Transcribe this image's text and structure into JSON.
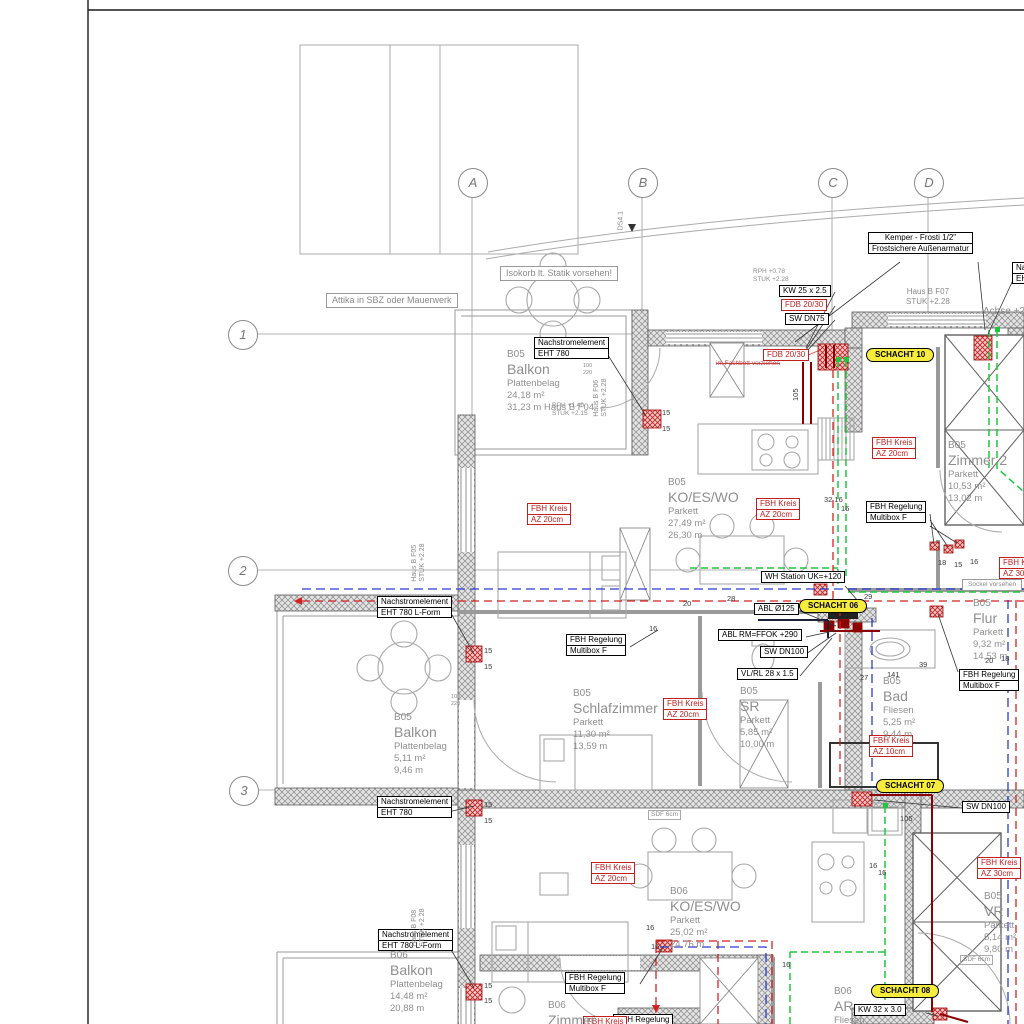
{
  "title": "Grundriss Haus B - Heizung/Sanitaer Installationsplan",
  "colors": {
    "pipe_green": "#1ec73c",
    "pipe_red_dashed": "#d42222",
    "pipe_blue_dashed": "#2b3bd4",
    "pipe_dark_red": "#8b0000",
    "label_red": "#c21f1f",
    "schacht_yellow": "#f6ec3d",
    "wall_hatch_gray": "#e3e3e3",
    "room_text_gray": "#8f8f8f"
  },
  "axes": {
    "letters": [
      {
        "label": "A",
        "x": 472,
        "y": 182
      },
      {
        "label": "B",
        "x": 642,
        "y": 182
      },
      {
        "label": "C",
        "x": 832,
        "y": 182
      },
      {
        "label": "D",
        "x": 928,
        "y": 182
      }
    ],
    "numbers": [
      {
        "label": "1",
        "x": 242,
        "y": 334
      },
      {
        "label": "2",
        "x": 242,
        "y": 570
      },
      {
        "label": "3",
        "x": 243,
        "y": 790
      }
    ]
  },
  "annotations": {
    "notes": [
      {
        "x": 534,
        "y": 337,
        "lines": [
          "Nachstromelement",
          "EHT 780"
        ]
      },
      {
        "x": 868,
        "y": 232,
        "center": true,
        "lines": [
          "Kemper - Frosti 1/2\"",
          "Frostsichere Außenarmatur"
        ]
      },
      {
        "x": 779,
        "y": 285,
        "lines": [
          "KW 25 x 2.5"
        ]
      },
      {
        "x": 781,
        "y": 299,
        "red": true,
        "lines": [
          "FDB 20/30"
        ]
      },
      {
        "x": 785,
        "y": 313,
        "lines": [
          "SW DN75"
        ]
      },
      {
        "x": 377,
        "y": 596,
        "lines": [
          "Nachstromelement",
          "EHT 780 L-Form"
        ]
      },
      {
        "x": 866,
        "y": 501,
        "lines": [
          "FBH Regelung",
          "Multibox F"
        ]
      },
      {
        "x": 566,
        "y": 634,
        "lines": [
          "FBH Regelung",
          "Multibox F"
        ]
      },
      {
        "x": 761,
        "y": 571,
        "lines": [
          "WH Station UK=+120"
        ]
      },
      {
        "x": 754,
        "y": 603,
        "lines": [
          "ABL Ø125"
        ]
      },
      {
        "x": 718,
        "y": 629,
        "lines": [
          "ABL RM=FFOK +290"
        ]
      },
      {
        "x": 760,
        "y": 646,
        "lines": [
          "SW DN100"
        ]
      },
      {
        "x": 737,
        "y": 668,
        "lines": [
          "VL/RL 28 x 1.5"
        ]
      },
      {
        "x": 959,
        "y": 669,
        "lines": [
          "FBH Regelung",
          "Multibox F"
        ]
      },
      {
        "x": 377,
        "y": 796,
        "lines": [
          "Nachstromelement",
          "EHT 780"
        ]
      },
      {
        "x": 962,
        "y": 801,
        "lines": [
          "SW DN100"
        ]
      },
      {
        "x": 378,
        "y": 929,
        "lines": [
          "Nachstromelement",
          "EHT 780 L-Form"
        ]
      },
      {
        "x": 565,
        "y": 972,
        "lines": [
          "FBH Regelung",
          "Multibox F"
        ]
      },
      {
        "x": 854,
        "y": 1004,
        "lines": [
          "KW 32 x 3.0"
        ]
      },
      {
        "x": 613,
        "y": 1014,
        "lines": [
          "FBH Regelung",
          "Multibox F"
        ]
      },
      {
        "x": 1012,
        "y": 262,
        "lines": [
          "Nachstromelement",
          "EHT 780"
        ]
      },
      {
        "x": 326,
        "y": 293,
        "gray": true,
        "lines": [
          "Attika in SBZ oder Mauerwerk"
        ]
      },
      {
        "x": 500,
        "y": 266,
        "gray": true,
        "lines": [
          "Isokorb lt. Statik vorsehen!"
        ]
      },
      {
        "x": 962,
        "y": 579,
        "gray": true,
        "small": true,
        "lines": [
          "Sockel vorsehen"
        ]
      }
    ],
    "fbh": [
      {
        "x": 527,
        "y": 503,
        "lines": [
          "FBH Kreis",
          "AZ 20cm"
        ]
      },
      {
        "x": 756,
        "y": 498,
        "lines": [
          "FBH Kreis",
          "AZ 20cm"
        ]
      },
      {
        "x": 872,
        "y": 437,
        "lines": [
          "FBH Kreis",
          "AZ 20cm"
        ]
      },
      {
        "x": 663,
        "y": 698,
        "lines": [
          "FBH Kreis",
          "AZ 20cm"
        ]
      },
      {
        "x": 869,
        "y": 735,
        "lines": [
          "FBH Kreis",
          "AZ 10cm"
        ]
      },
      {
        "x": 977,
        "y": 857,
        "lines": [
          "FBH Kreis",
          "AZ 30cm"
        ]
      },
      {
        "x": 999,
        "y": 557,
        "lines": [
          "FBH Kreis",
          "AZ 30cm"
        ]
      },
      {
        "x": 591,
        "y": 862,
        "lines": [
          "FBH Kreis",
          "AZ 20cm"
        ]
      },
      {
        "x": 583,
        "y": 1016,
        "lines": [
          "FBH Kreis"
        ]
      },
      {
        "x": 763,
        "y": 349,
        "lines": [
          "FDB 20/30"
        ]
      }
    ],
    "schachts": [
      {
        "x": 866,
        "y": 348,
        "label": "SCHACHT 10"
      },
      {
        "x": 799,
        "y": 599,
        "label": "SCHACHT 06"
      },
      {
        "x": 876,
        "y": 779,
        "label": "SCHACHT 07"
      },
      {
        "x": 871,
        "y": 984,
        "label": "SCHACHT 08"
      }
    ],
    "redtexts": [
      {
        "x": 716,
        "y": 360,
        "text": "im Fachbett vorziehen"
      }
    ]
  },
  "rooms": [
    {
      "x": 507,
      "y": 349,
      "head": "B05",
      "name": "Balkon",
      "details": [
        "Plattenbelag",
        "24,18 m²",
        "31,23 m  Haus B F04"
      ]
    },
    {
      "x": 668,
      "y": 477,
      "head": "B05",
      "name": "KO/ES/WO",
      "details": [
        "Parkett",
        "27,49 m²",
        "26,30 m"
      ]
    },
    {
      "x": 948,
      "y": 440,
      "head": "B05",
      "name": "Zimmer 2",
      "details": [
        "Parkett",
        "10,53 m²",
        "13,02 m"
      ]
    },
    {
      "x": 573,
      "y": 688,
      "head": "B05",
      "name": "Schlafzimmer",
      "details": [
        "Parkett",
        "11,30 m²",
        "13,59 m"
      ]
    },
    {
      "x": 394,
      "y": 712,
      "head": "B05",
      "name": "Balkon",
      "details": [
        "Plattenbelag",
        "5,11 m²",
        "9,46 m"
      ]
    },
    {
      "x": 740,
      "y": 686,
      "head": "B05",
      "name": "SR",
      "details": [
        "Parkett",
        "5,85 m²",
        "10,00 m"
      ]
    },
    {
      "x": 883,
      "y": 676,
      "head": "B05",
      "name": "Bad",
      "details": [
        "Fliesen",
        "5,25 m²",
        "9,44 m"
      ]
    },
    {
      "x": 973,
      "y": 598,
      "head": "B05",
      "name": "Flur",
      "details": [
        "Parkett",
        "9,32 m²",
        "14,53 m"
      ]
    },
    {
      "x": 984,
      "y": 891,
      "head": "B05",
      "name": "VR",
      "details": [
        "Parkett",
        "5,14 m²",
        "9,80 m"
      ]
    },
    {
      "x": 670,
      "y": 886,
      "head": "B06",
      "name": "KO/ES/WO",
      "details": [
        "Parkett",
        "25,02 m²",
        "24,76 m"
      ]
    },
    {
      "x": 390,
      "y": 950,
      "head": "B06",
      "name": "Balkon",
      "details": [
        "Plattenbelag",
        "14,48 m²",
        "20,88 m"
      ]
    },
    {
      "x": 548,
      "y": 1000,
      "head": "B06",
      "name": "Zimmer",
      "details": []
    },
    {
      "x": 834,
      "y": 986,
      "head": "B06",
      "name": "AR",
      "details": [
        "Fliesen"
      ]
    }
  ],
  "plains": [
    {
      "x": 906,
      "y": 287,
      "size": 8,
      "center": true,
      "lines": [
        "Haus B F07",
        "STUK +2.28"
      ]
    },
    {
      "x": 983,
      "y": 306,
      "size": 10,
      "lines": [
        "Achse +2,0"
      ]
    },
    {
      "x": 753,
      "y": 268,
      "size": 6.5,
      "lines": [
        "RPH  +0.78",
        "STUK +2.28"
      ]
    },
    {
      "x": 552,
      "y": 402,
      "size": 6.5,
      "lines": [
        "RPH  +1.40",
        "STUK +2.15"
      ]
    },
    {
      "x": 648,
      "y": 810,
      "size": 6.5,
      "boxed": true,
      "lines": [
        "SDF 6cm"
      ]
    },
    {
      "x": 960,
      "y": 955,
      "size": 6.5,
      "boxed": true,
      "lines": [
        "SDF 6cm"
      ]
    },
    {
      "x": 583,
      "y": 363,
      "size": 5.5,
      "lines": [
        "100",
        "220"
      ]
    },
    {
      "x": 451,
      "y": 694,
      "size": 5.5,
      "lines": [
        "100",
        "220"
      ]
    }
  ],
  "vtexts": [
    {
      "x": 610,
      "y": 400,
      "lines": [
        "Haus B F06",
        "STUK +2.28"
      ]
    },
    {
      "x": 428,
      "y": 565,
      "lines": [
        "Haus B F05",
        "STUK +2.28"
      ]
    },
    {
      "x": 428,
      "y": 930,
      "lines": [
        "Haus B F08",
        "STUK +2.28"
      ]
    },
    {
      "x": 626,
      "y": 222,
      "lines": [
        "DS4.1"
      ]
    },
    {
      "x": 800,
      "y": 392,
      "dim": true,
      "lines": [
        "105"
      ]
    }
  ],
  "dims": [
    {
      "t": "15",
      "x": 662,
      "y": 408
    },
    {
      "t": "15",
      "x": 662,
      "y": 424
    },
    {
      "t": "15",
      "x": 484,
      "y": 646
    },
    {
      "t": "15",
      "x": 484,
      "y": 662
    },
    {
      "t": "15",
      "x": 484,
      "y": 800
    },
    {
      "t": "15",
      "x": 484,
      "y": 816
    },
    {
      "t": "15",
      "x": 484,
      "y": 981
    },
    {
      "t": "15",
      "x": 484,
      "y": 996
    },
    {
      "t": "105",
      "x": 900,
      "y": 814
    },
    {
      "t": "141",
      "x": 887,
      "y": 670
    },
    {
      "t": "39",
      "x": 919,
      "y": 660
    },
    {
      "t": "27",
      "x": 860,
      "y": 673
    },
    {
      "t": "32 16",
      "x": 824,
      "y": 495
    },
    {
      "t": "16",
      "x": 841,
      "y": 504
    },
    {
      "t": "16",
      "x": 649,
      "y": 624
    },
    {
      "t": "18",
      "x": 938,
      "y": 558
    },
    {
      "t": "15",
      "x": 954,
      "y": 560
    },
    {
      "t": "16",
      "x": 970,
      "y": 557
    },
    {
      "t": "20",
      "x": 985,
      "y": 656
    },
    {
      "t": "18",
      "x": 1001,
      "y": 654
    },
    {
      "t": "29",
      "x": 864,
      "y": 592
    },
    {
      "t": "28",
      "x": 727,
      "y": 594
    },
    {
      "t": "16",
      "x": 646,
      "y": 923
    },
    {
      "t": "16",
      "x": 651,
      "y": 942
    },
    {
      "t": "16",
      "x": 869,
      "y": 861
    },
    {
      "t": "16",
      "x": 878,
      "y": 868
    },
    {
      "t": "16",
      "x": 782,
      "y": 960
    },
    {
      "t": "20",
      "x": 683,
      "y": 599
    }
  ]
}
